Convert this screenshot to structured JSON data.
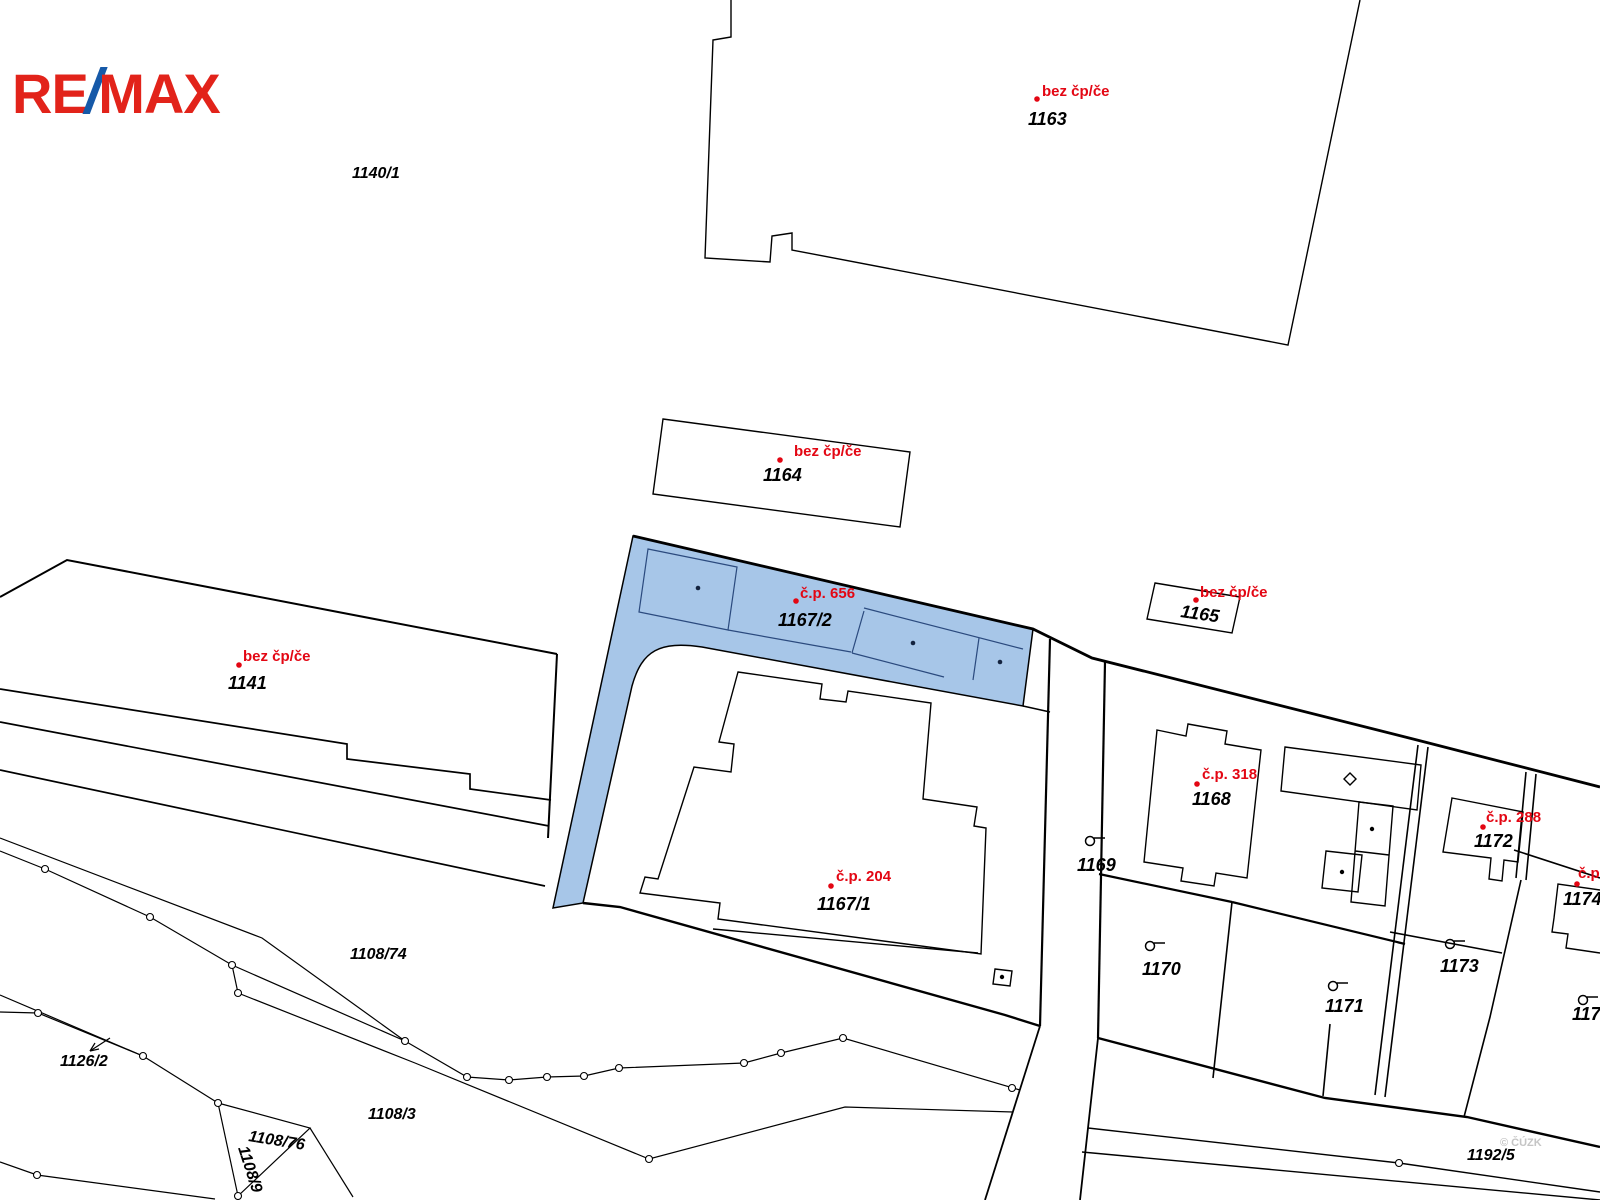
{
  "logo": {
    "re": "RE",
    "slash": "/",
    "max": "MAX"
  },
  "watermark": "© ČÚZK",
  "colors": {
    "parcel_highlight_fill": "#A7C6E8",
    "parcel_highlight_line": "#2B4A7E",
    "label_red": "#E30613",
    "number_black": "#000000",
    "logo_red": "#E2231A",
    "logo_blue": "#1659A8",
    "watermark_gray": "#C5C5C5",
    "map_line": "#000000"
  },
  "building_labels": {
    "b1163": {
      "label": "bez čp/če",
      "number": "1163"
    },
    "b1164": {
      "label": "bez čp/če",
      "number": "1164"
    },
    "b1165": {
      "label": "bez čp/če",
      "number": "1165"
    },
    "b1141": {
      "label": "bez čp/če",
      "number": "1141"
    },
    "b656": {
      "label": "č.p. 656",
      "number": "1167/2"
    },
    "b204": {
      "label": "č.p. 204",
      "number": "1167/1"
    },
    "b318": {
      "label": "č.p. 318",
      "number": "1168"
    },
    "b288": {
      "label": "č.p. 288",
      "number": "1172"
    },
    "bedge": {
      "label": "č.p.",
      "number": "1174/1"
    }
  },
  "parcel_labels": {
    "p1140_1": "1140/1",
    "p1169": "1169",
    "p1170": "1170",
    "p1171": "1171",
    "p1173": "1173",
    "p1175": "1175",
    "p1192_5": "1192/5",
    "p1108_74": "1108/74",
    "p1108_3": "1108/3",
    "p1108_76": "1108/76",
    "p1108_9": "1108/9",
    "p1126_2": "1126/2"
  }
}
